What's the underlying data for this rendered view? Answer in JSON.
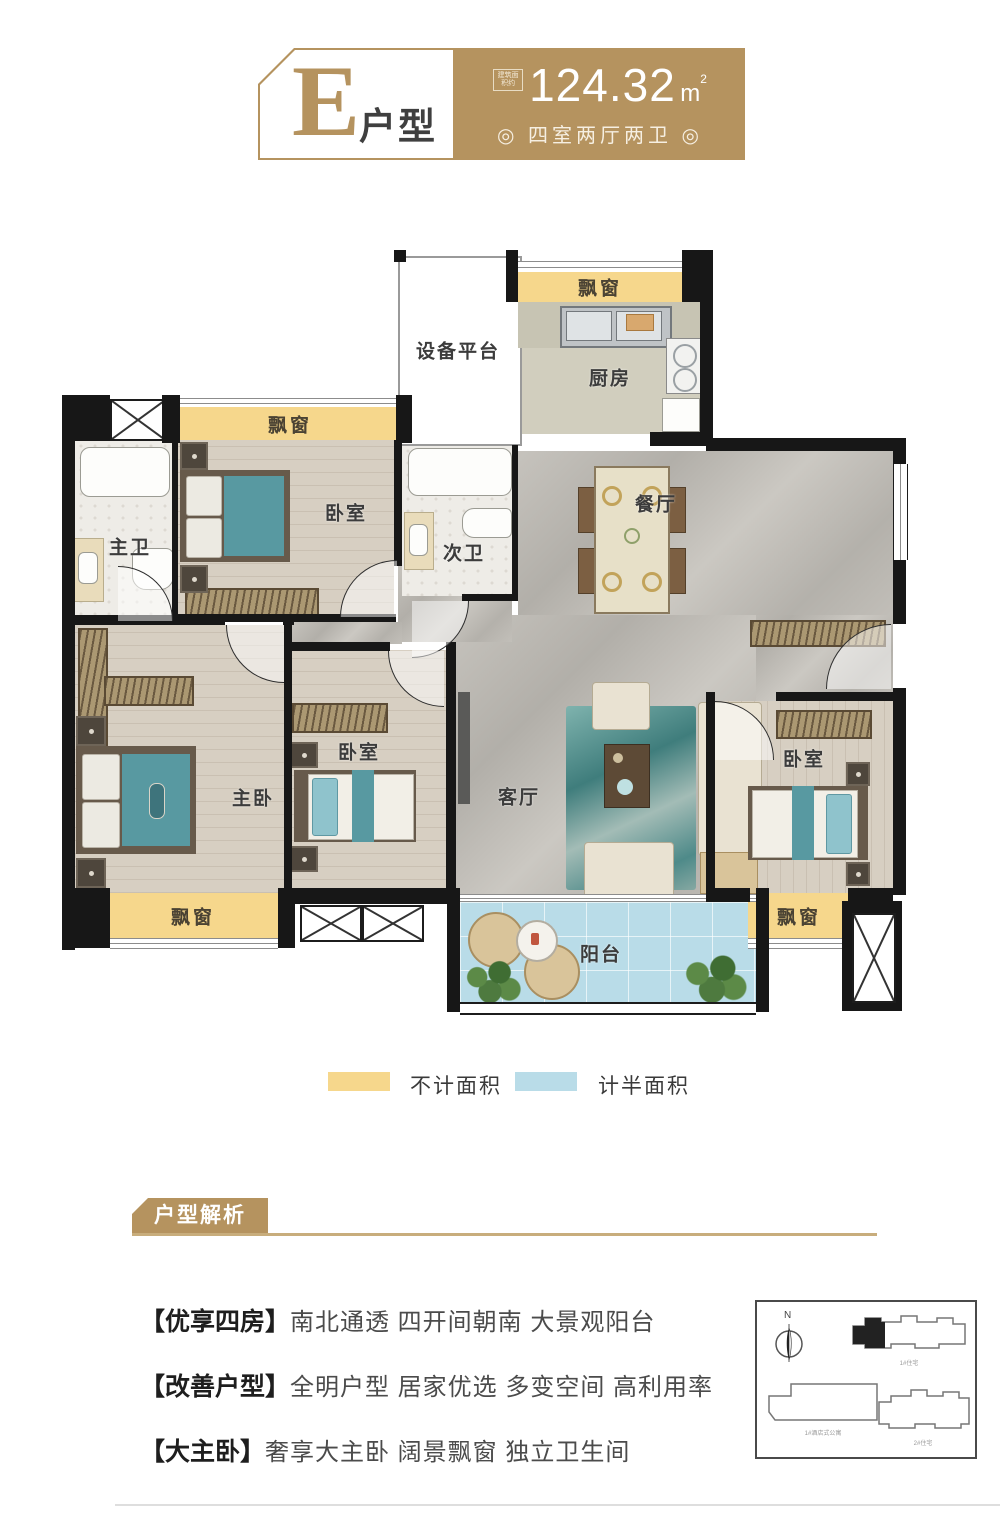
{
  "header": {
    "unit_letter": "E",
    "unit_type": "户型",
    "area_label": "建筑面积约",
    "area_value": "124.32",
    "area_unit": "m",
    "area_exp": "2",
    "layout_spec": "◎ 四室两厅两卫 ◎"
  },
  "floorplan": {
    "bay_window": "飘窗",
    "rooms": {
      "equipment_platform": "设备平台",
      "kitchen": "厨房",
      "dining": "餐厅",
      "master_bath": "主卫",
      "bedroom_top": "卧室",
      "second_bath": "次卫",
      "master_bedroom": "主卧",
      "bedroom_mid": "卧室",
      "living": "客厅",
      "bedroom_right": "卧室",
      "balcony": "阳台"
    }
  },
  "legend": {
    "items": [
      {
        "label": "不计面积",
        "color": "#f6d78c"
      },
      {
        "label": "计半面积",
        "color": "#b9dce8"
      }
    ]
  },
  "analysis": {
    "title": "户型解析",
    "items": [
      {
        "tag": "【优享四房】",
        "text": "南北通透 四开间朝南 大景观阳台"
      },
      {
        "tag": "【改善户型】",
        "text": "全明户型 居家优选 多变空间 高利用率"
      },
      {
        "tag": "【大主卧】",
        "text": "奢享大主卧 阔景飘窗 独立卫生间"
      }
    ]
  },
  "sitemap": {
    "compass": "N",
    "building_top": "1#住宅",
    "building_bottom_left": "1#酒店式公寓",
    "building_bottom_right": "2#住宅"
  },
  "colors": {
    "gold": "#b5935f",
    "bay_yellow": "#f6d78c",
    "balcony_blue": "#b9dce8"
  }
}
